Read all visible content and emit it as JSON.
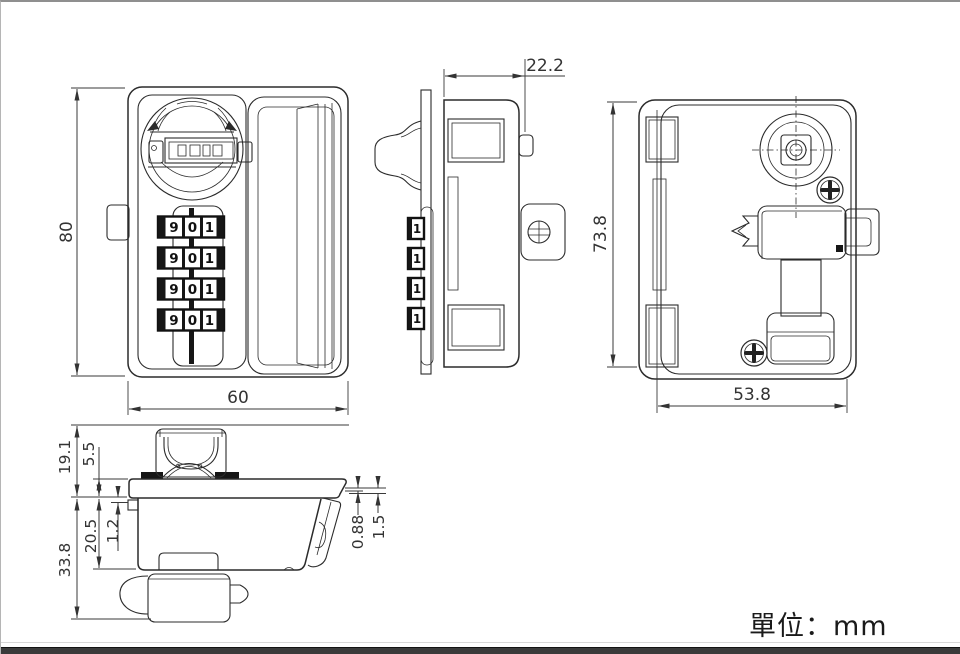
{
  "page": {
    "unit_label": "單位：mm",
    "line_color": "#2b2b2b",
    "dim_color": "#333333",
    "footer_bar_color": "#3a3a3a"
  },
  "views": {
    "front": {
      "dims": {
        "height": "80",
        "width": "60"
      },
      "wheel_rows": [
        [
          "9",
          "0",
          "1"
        ],
        [
          "9",
          "0",
          "1"
        ],
        [
          "9",
          "0",
          "1"
        ],
        [
          "9",
          "0",
          "1"
        ]
      ]
    },
    "side": {
      "dims": {
        "depth": "22.2"
      },
      "wheel_digits": [
        "1",
        "1",
        "1",
        "1"
      ]
    },
    "back": {
      "dims": {
        "height": "73.8",
        "width": "53.8"
      }
    },
    "bottom": {
      "dims": {
        "upper_height": "19.1",
        "knob_offset": "5.5",
        "total_height": "33.8",
        "body_depth": "20.5",
        "flange_lip": "1.2",
        "panel_min": "0.88",
        "panel_max": "1.5"
      }
    }
  }
}
